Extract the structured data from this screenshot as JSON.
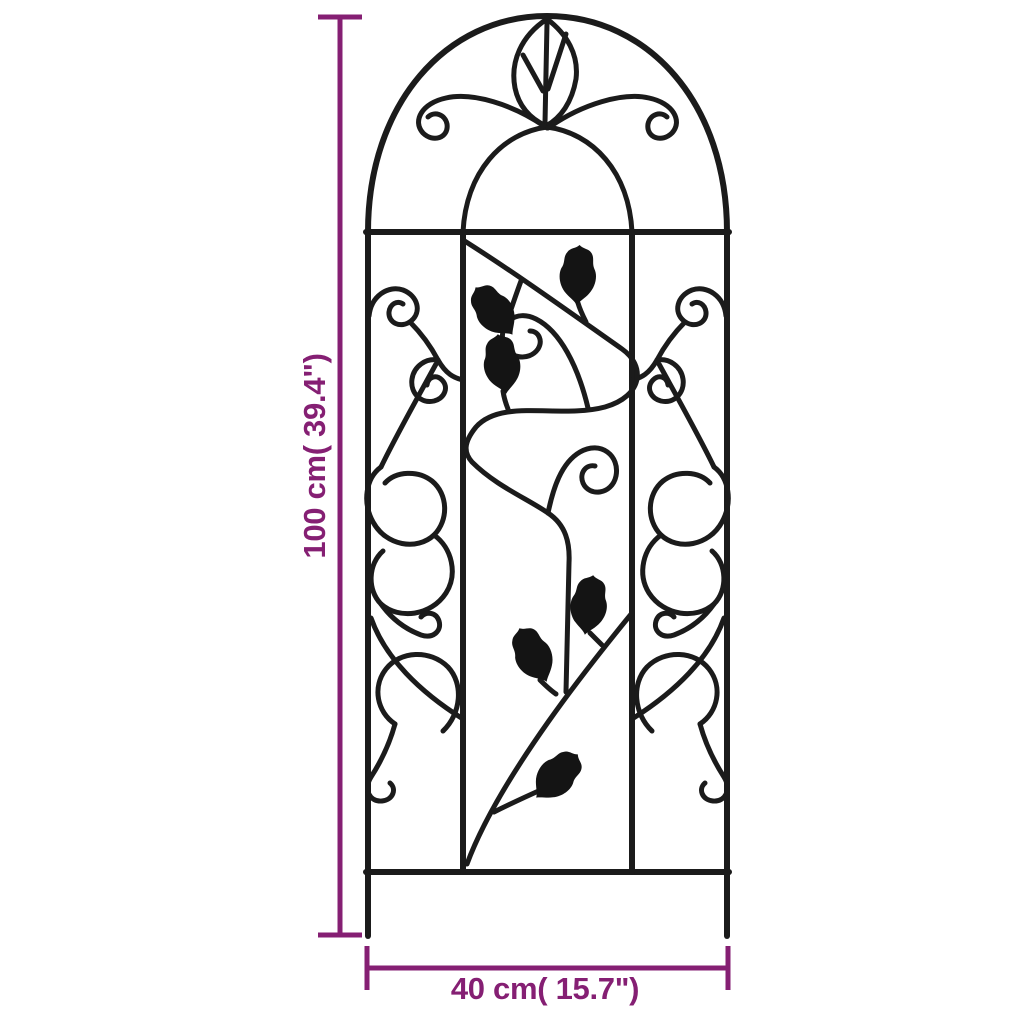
{
  "page": {
    "background_color": "#ffffff"
  },
  "illustration": {
    "name": "arched garden trellis line drawing",
    "stroke_color": "#1b1b1b",
    "ornaments": {
      "top_leaf": "outlined leaf with veins at arch apex",
      "side_panels": "mirrored wrought-iron scrolls and loops",
      "center_panel": "winding vine with 6 solid black leaves and 2 spiral scrolls"
    }
  },
  "dimensions": {
    "accent_color": "#851f73",
    "height": {
      "label": "100 cm( 39.4\")"
    },
    "width": {
      "label": "40 cm( 15.7\")"
    }
  }
}
